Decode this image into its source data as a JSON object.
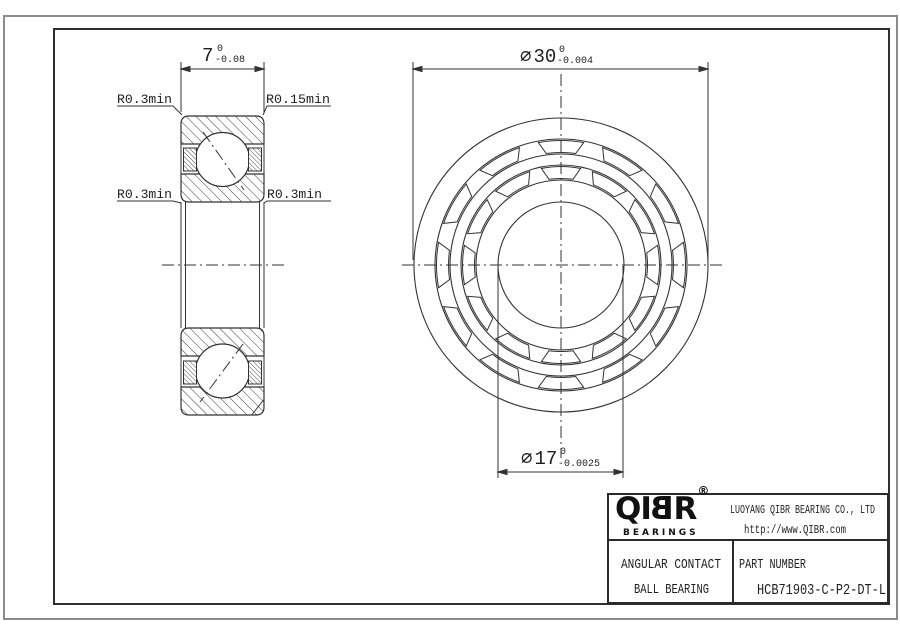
{
  "dimensions": {
    "width": {
      "value": "7",
      "tol_top": "0",
      "tol_bottom": "-0.08"
    },
    "outer_dia": {
      "symbol": "∅",
      "value": "30",
      "tol_top": "0",
      "tol_bottom": "-0.004"
    },
    "bore_dia": {
      "symbol": "∅",
      "value": "17",
      "tol_top": "0",
      "tol_bottom": "-0.0025"
    }
  },
  "labels": {
    "radius_top_left": "R0.3min",
    "radius_top_right": "R0.15min",
    "radius_mid_left": "R0.3min",
    "radius_mid_right": "R0.3min"
  },
  "title_block": {
    "logo_part1": "QI",
    "logo_part2": "B",
    "logo_part3": "R",
    "registered": "®",
    "logo_sub": "BEARINGS",
    "company": "LUOYANG QIBR BEARING CO., LTD",
    "website": "http://www.QIBR.com",
    "type_line1": "ANGULAR CONTACT",
    "type_line2": "BALL BEARING",
    "part_label": "PART NUMBER",
    "part_number": "HCB71903-C-P2-DT-L"
  },
  "colors": {
    "line": "#333333",
    "sheet_border": "#8c8c8c",
    "text": "#1e1e1e"
  }
}
